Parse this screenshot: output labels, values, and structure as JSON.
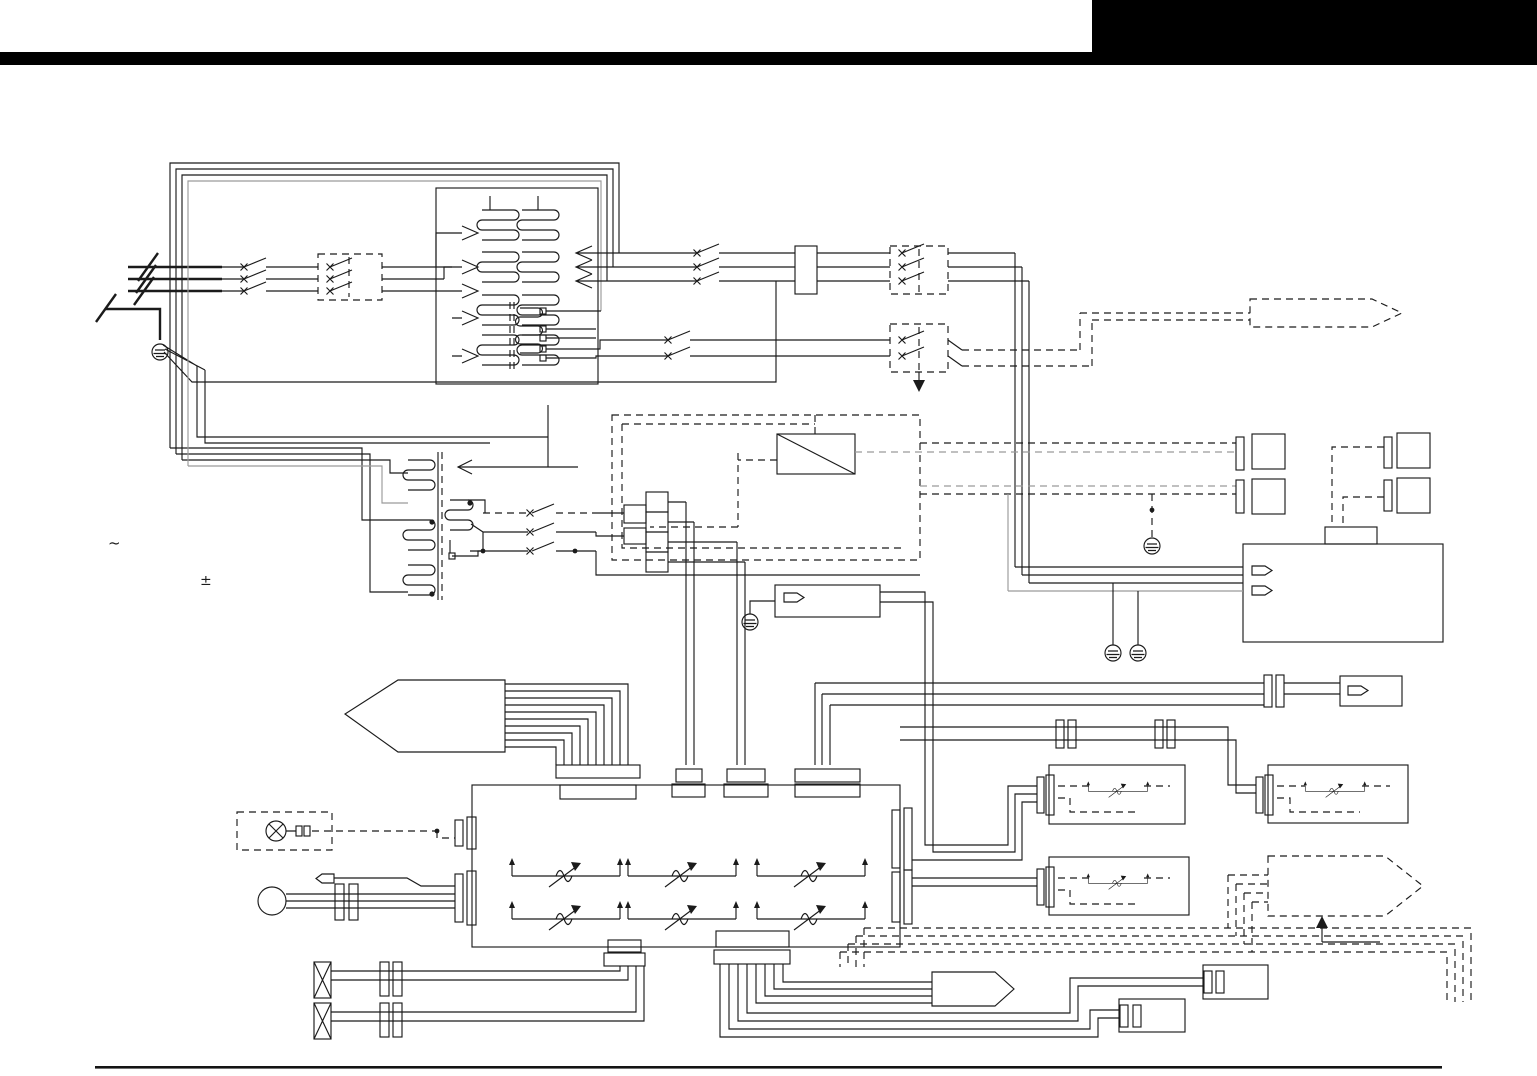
{
  "page": {
    "type": "service-manual wiring diagram page",
    "background": "#ffffff",
    "header": {
      "bar_color": "#000000",
      "block_color": "#000000"
    },
    "footer": {
      "rule_color": "#141414"
    }
  },
  "labels": {
    "ac_symbol": "~",
    "polarity_symbol": "±"
  },
  "diagram": {
    "ink_color": "#1b1b1b",
    "grey_color": "#9a9a9a",
    "components": [
      {
        "name": "three-phase-supply-input",
        "type": "power lines with disconnect slashes"
      },
      {
        "name": "earth-ground",
        "type": "protective-earth symbols",
        "count": 5
      },
      {
        "name": "line-contactor",
        "type": "dashed contactor box",
        "count": 3
      },
      {
        "name": "main-transformer",
        "type": "multi-winding transformer with tap arrows"
      },
      {
        "name": "control-transformer",
        "type": "transformer with polarity dots"
      },
      {
        "name": "output-terminal-block",
        "type": "terminal rectangle"
      },
      {
        "name": "rectifier",
        "type": "box with diagonal"
      },
      {
        "name": "relay-contacts",
        "type": "switch contacts",
        "count": 3
      },
      {
        "name": "terminal-stack",
        "type": "4-square terminal strip"
      },
      {
        "name": "sense-module",
        "type": "box with pin lug and ground"
      },
      {
        "name": "control-pcb",
        "type": "main board with connectors"
      },
      {
        "name": "trimmer-potentiometer",
        "type": "adjustable resistor symbol",
        "count": 9
      },
      {
        "name": "indicator-lamp",
        "type": "circle-X lamp in dashed box"
      },
      {
        "name": "control-knob",
        "type": "circle with 3-wire lead"
      },
      {
        "name": "cooling-fan",
        "type": "crossed box",
        "count": 2
      },
      {
        "name": "wire-harness-arrow",
        "type": "pentagon harness pointer",
        "count": 4
      },
      {
        "name": "remote-connector",
        "type": "plug bar with square receptacle",
        "count": 4
      },
      {
        "name": "power-supply-box",
        "type": "box with pin lugs and grounds"
      },
      {
        "name": "trimmer-option-box",
        "type": "box with trimmer and dashed wiring",
        "count": 3
      }
    ]
  }
}
